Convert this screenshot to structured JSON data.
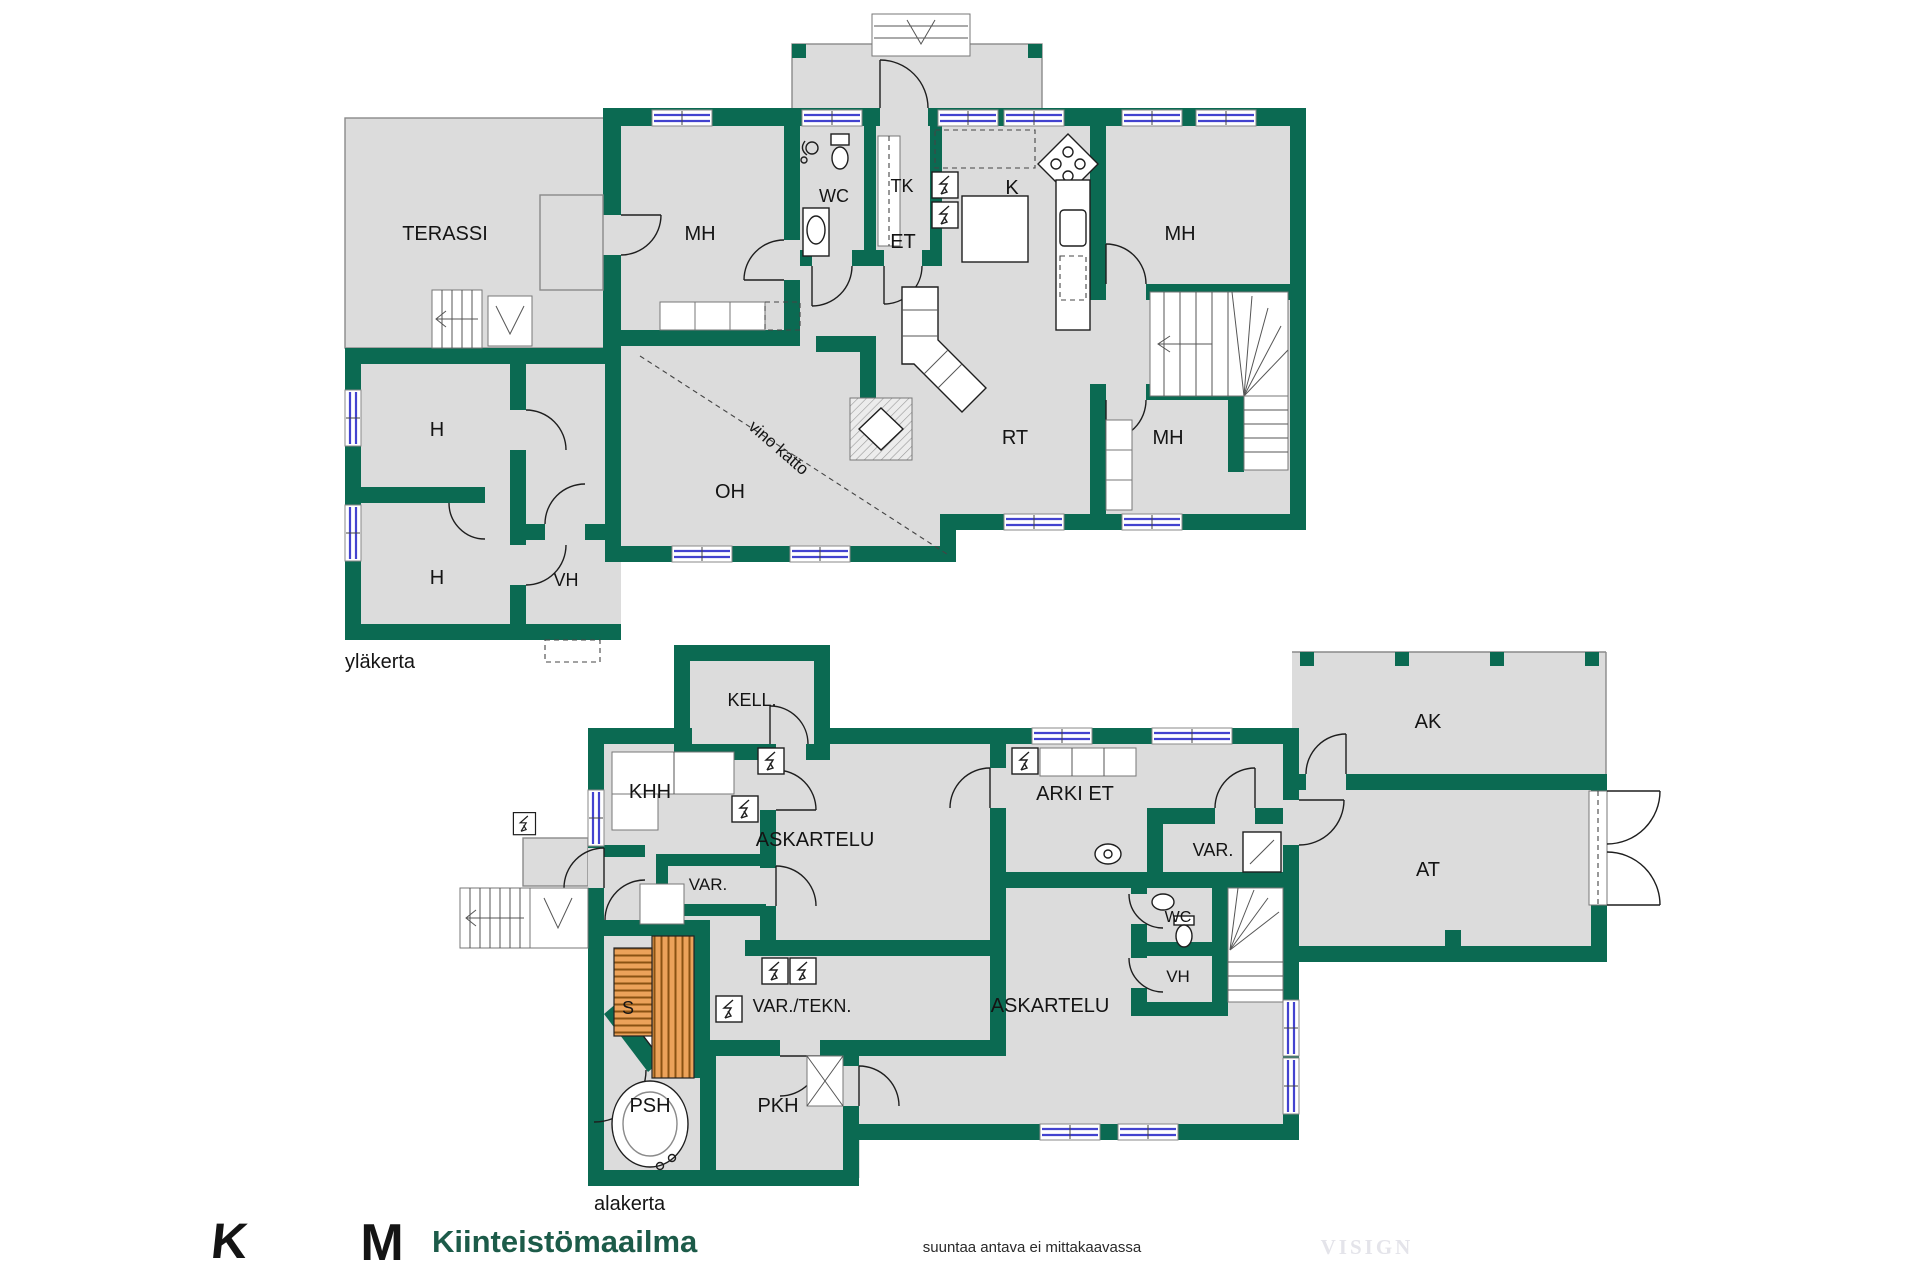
{
  "page": {
    "background": "#ffffff"
  },
  "floors": {
    "upper_label": "yläkerta",
    "lower_label": "alakerta"
  },
  "labels": {
    "terassi": "TERASSI",
    "mh": "MH",
    "wc": "WC",
    "tk": "TK",
    "k": "K",
    "et": "ET",
    "rt": "RT",
    "oh": "OH",
    "h": "H",
    "vh": "VH",
    "vino_katto": "vino katto",
    "kell": "KELL.",
    "khh": "KHH",
    "askartelu": "ASKARTELU",
    "arki_et": "ARKI ET",
    "var": "VAR.",
    "var_tekn": "VAR./TEKN.",
    "s": "S",
    "psh": "PSH",
    "pkh": "PKH",
    "ak": "AK",
    "at": "AT"
  },
  "footer": {
    "brand_mark_k": "K",
    "brand_mark_m": "M",
    "brand_name": "Kiinteistömaailma",
    "disclaimer": "suuntaa antava ei mittakaavassa",
    "watermark": "VISIGN"
  },
  "colors": {
    "wall": "#0b6a52",
    "floor": "#dcdcdc",
    "window": "#4343cf",
    "bench": "#eca25a",
    "bench_line": "#8a5213",
    "logo_dark": "#1c5b49",
    "logo_light": "#41c27b",
    "watermark": "#e4e4ea"
  }
}
